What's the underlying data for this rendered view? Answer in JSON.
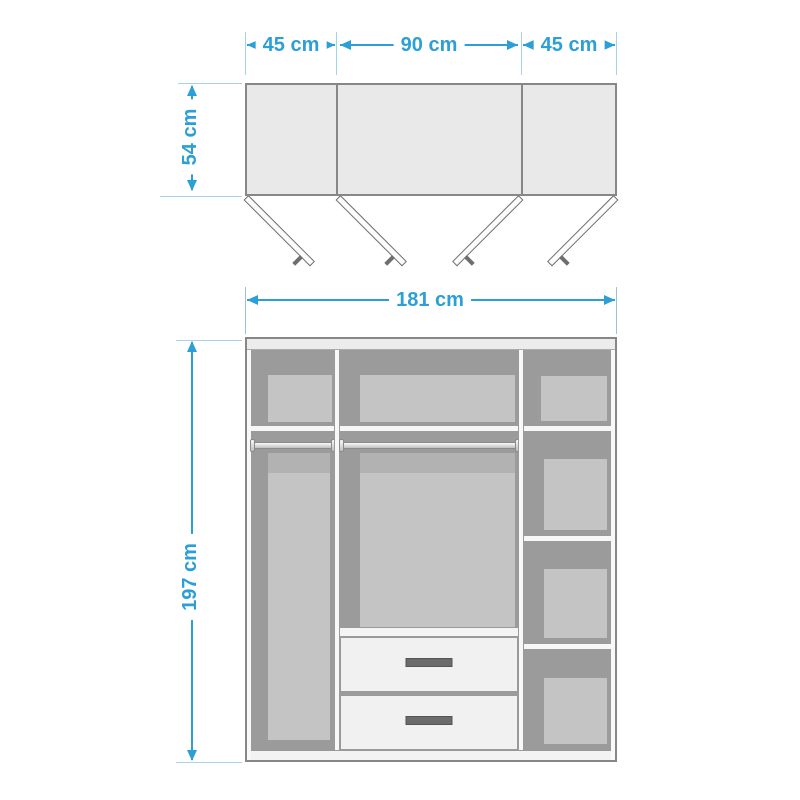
{
  "diagram": {
    "type": "wardrobe-dimension-diagram",
    "accent_color": "#2B9FD6",
    "icons": {
      "dimension_arrow": "css-triangle",
      "open_door_symbol": "angled-bar-with-handle"
    },
    "top_view": {
      "width_left": "45 cm",
      "width_middle": "90 cm",
      "width_right": "45 cm",
      "depth": "54 cm"
    },
    "front_view": {
      "total_width": "181 cm",
      "total_height": "197 cm"
    }
  }
}
